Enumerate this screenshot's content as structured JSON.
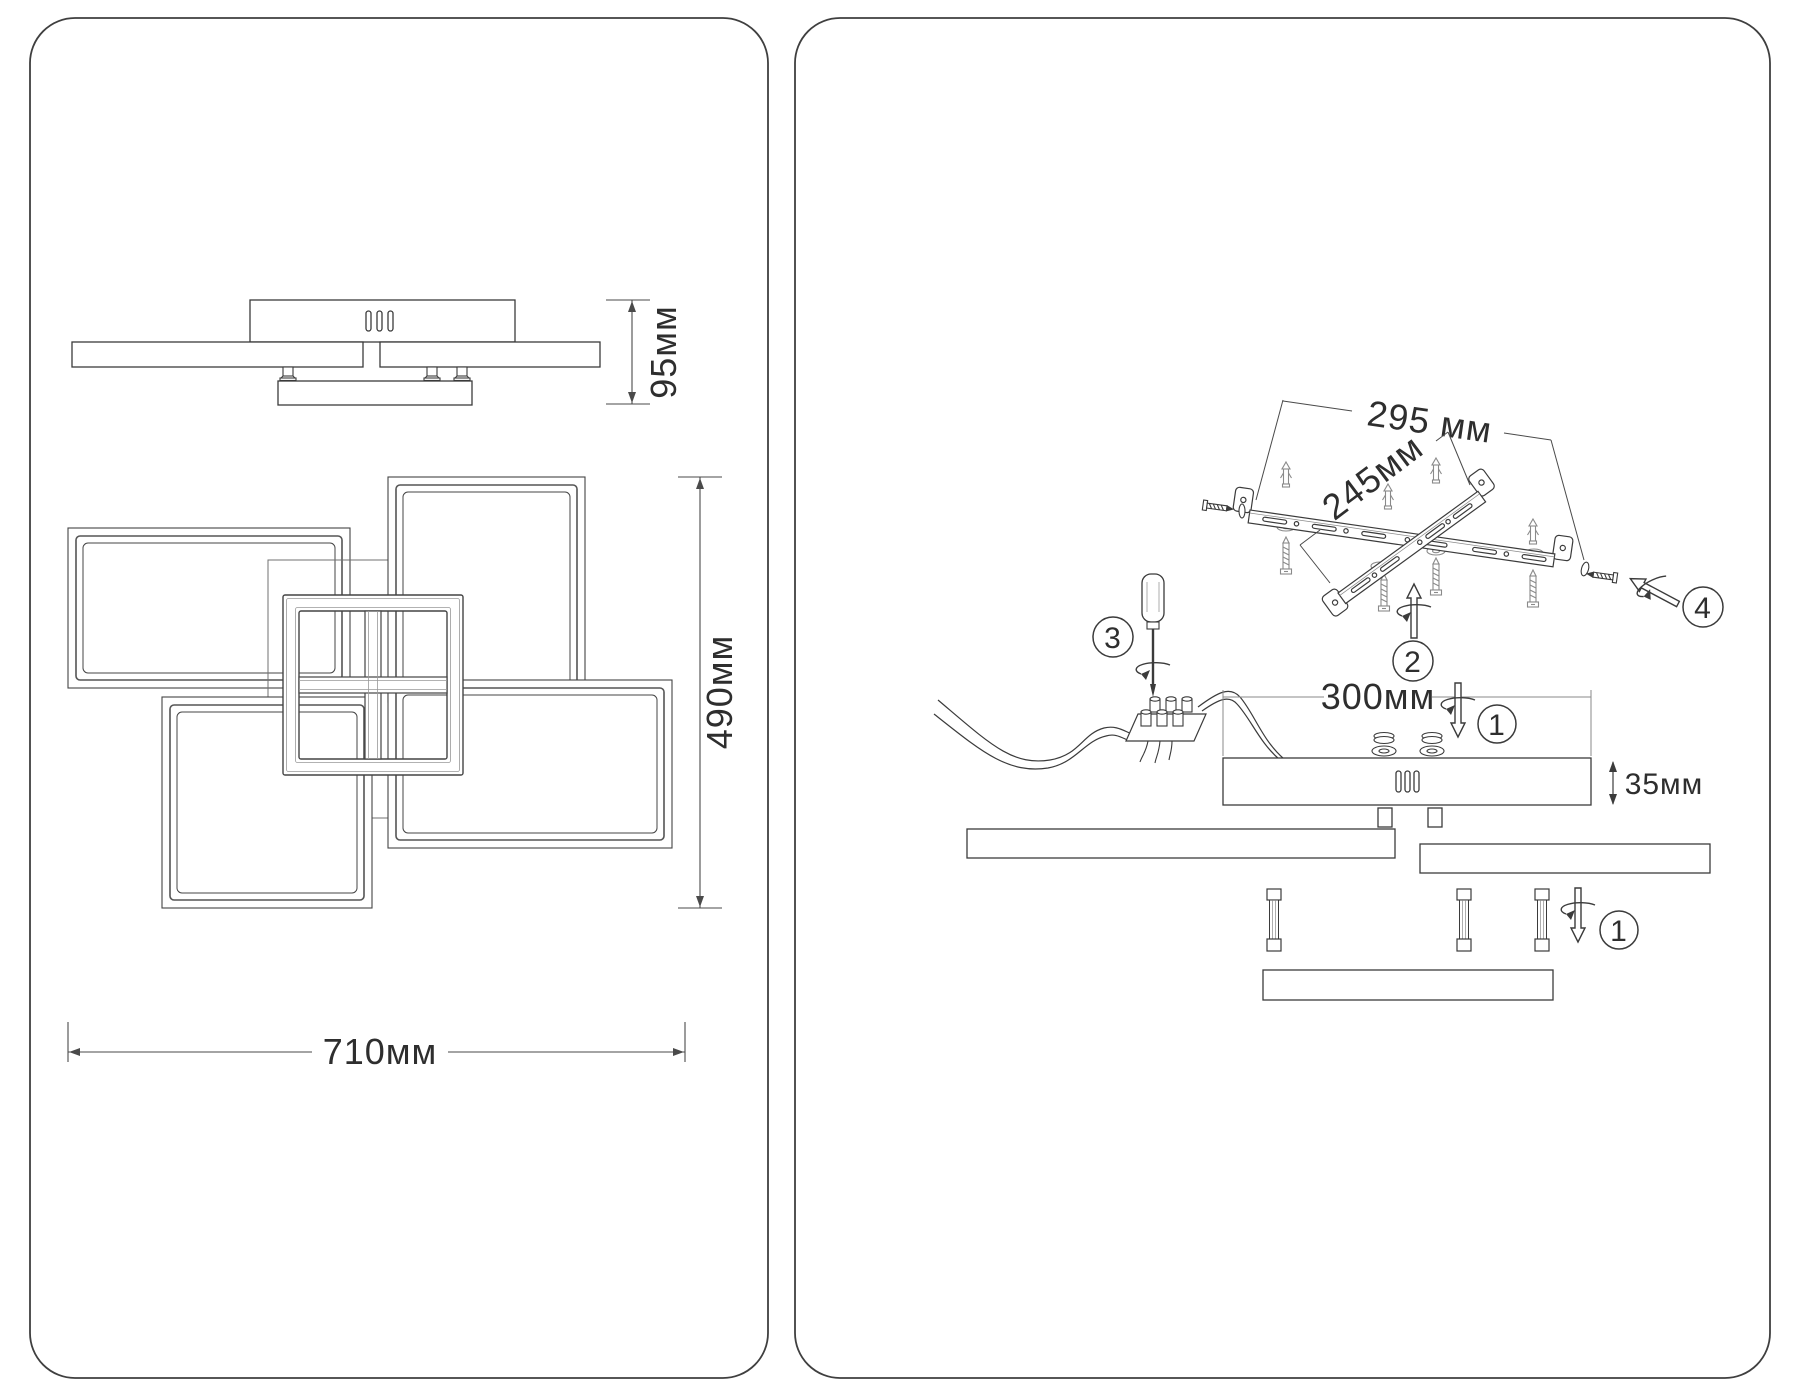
{
  "panels": {
    "left": {
      "side_view": {
        "height": "95мм"
      },
      "top_view": {
        "width": "710мм",
        "height": "490мм"
      }
    },
    "right": {
      "bracket": {
        "dim_a": "295 мм",
        "dim_b": "245мм"
      },
      "canopy": {
        "width": "300мм",
        "height": "35мм"
      },
      "steps": {
        "s1": "1",
        "s2": "2",
        "s3": "3",
        "s4": "4"
      }
    }
  }
}
